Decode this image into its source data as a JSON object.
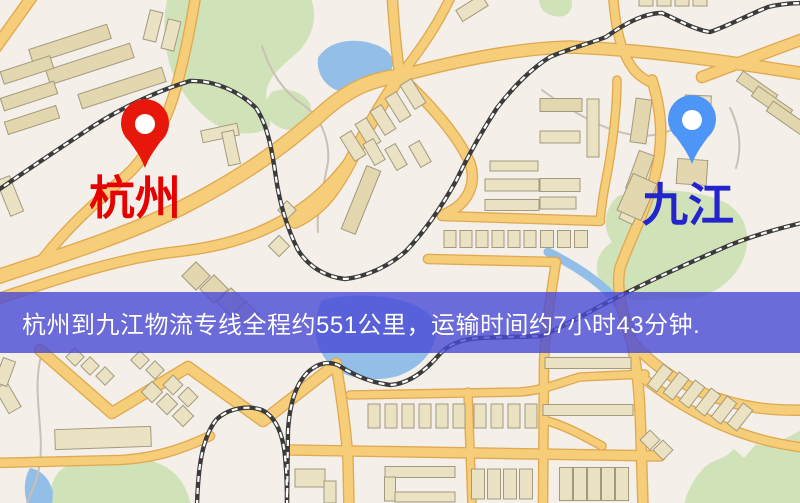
{
  "banner": {
    "text": "杭州到九江物流专线全程约551公里，运输时间约7小时43分钟.",
    "background_color": "rgba(74,74,214,0.8)",
    "text_color": "#ffffff",
    "top": 292,
    "height": 61
  },
  "map": {
    "background": "#f4efe8",
    "palette": {
      "green": "#cfe2b8",
      "water": "#93bee8",
      "road_fill": "#f6cd78",
      "road_casing": "#dfa851",
      "rail_dark": "#3b3b3b",
      "rail_light": "#ffffff",
      "building_fill": "#ebe2c4",
      "building_alt": "#e3d7af",
      "building_stroke": "#a39a7d",
      "trail": "#c9c1b3"
    },
    "labels": [
      {
        "id": "hangzhou",
        "text": "杭州",
        "color": "#e60000",
        "x": 135,
        "y": 214,
        "font_size": 46
      },
      {
        "id": "jiujiang",
        "text": "九江",
        "color": "#2424cd",
        "x": 688,
        "y": 221,
        "font_size": 46
      }
    ],
    "pins": [
      {
        "id": "hangzhou",
        "color": "#e8170b",
        "tip_x": 145,
        "tip_y": 168
      },
      {
        "id": "jiujiang",
        "color": "#4d95f6",
        "tip_x": 692,
        "tip_y": 164
      }
    ],
    "features": {
      "greens": [
        "M 168 -4 L 310 -4 C 318 14 314 34 300 50 C 285 64 272 72 267 88 C 264 104 272 114 270 126 C 258 136 238 136 218 126 C 198 114 180 94 170 66 C 163 40 163 16 168 -4 Z",
        "M 272 92 C 286 86 304 92 310 104 C 314 116 306 128 292 130 C 278 130 268 122 266 110 C 266 100 268 96 272 92 Z",
        "M 538 -4 L 570 -4 C 574 4 572 12 564 16 C 554 18 544 14 540 6 Z",
        "M 618 196 C 658 186 702 190 728 204 C 748 218 752 240 742 262 C 732 282 716 292 698 298 L 640 300 C 620 300 604 290 598 276 C 594 262 600 250 612 242 C 602 228 604 208 618 196 Z",
        "M 52 506 C 48 486 54 470 72 464 C 94 456 124 455 148 460 C 172 466 186 480 191 506 Z",
        "M 806 428 C 784 438 770 450 756 444 L 744 458 L 734 449 C 722 462 712 458 702 470 C 692 481 686 494 684 506 L 806 506 Z"
      ],
      "waters": [
        {
          "d": "M 318 58 C 326 44 346 38 366 42 C 386 46 396 56 392 68 C 386 82 366 92 344 92 C 328 90 316 76 318 58 Z",
          "mode": "fill"
        },
        {
          "d": "M 322 300 C 346 294 376 294 400 300 C 424 306 438 318 436 334 C 434 352 420 368 398 376 C 376 382 350 380 334 368 C 320 356 314 340 316 324 C 317 314 318 306 322 300 Z",
          "mode": "fill"
        },
        {
          "d": "M 30 468 C 42 470 50 480 53 492 L 52 506 L 28 506 C 23 492 24 478 30 468 Z",
          "mode": "fill"
        },
        {
          "d": "M 548 252 C 572 264 594 278 610 294 C 622 308 628 320 632 334",
          "mode": "stroke",
          "w": 9
        }
      ],
      "roads": [
        {
          "d": "M 34 -6 L -6 50",
          "w": 10
        },
        {
          "d": "M -6 278 C 60 256 130 234 185 206 C 243 176 283 148 322 113 C 352 86 375 79 400 76",
          "w": 13
        },
        {
          "d": "M -6 300 C 60 278 120 258 175 252 C 220 247 248 238 272 226 C 310 207 332 185 352 158",
          "w": 9
        },
        {
          "d": "M 400 76 C 382 103 366 130 352 158 C 334 193 320 210 295 222",
          "w": 11
        },
        {
          "d": "M 196 -6 C 190 30 184 60 176 88 C 168 116 154 146 132 170 C 112 190 78 214 42 260",
          "w": 9
        },
        {
          "d": "M 400 76 C 396 50 394 25 392 -6",
          "w": 9
        },
        {
          "d": "M 400 76 C 420 50 438 25 452 -6",
          "w": 8
        },
        {
          "d": "M 400 76 C 465 58 525 48 570 47 C 650 50 730 62 806 74",
          "w": 11
        },
        {
          "d": "M 702 77 C 740 63 772 50 806 38",
          "w": 10
        },
        {
          "d": "M 613 -6 C 615 25 620 52 634 70 C 640 77 646 80 652 83",
          "w": 8
        },
        {
          "d": "M 617 80 C 617 110 612 150 606 180 C 602 200 601 212 600 221",
          "w": 7
        },
        {
          "d": "M 652 80 C 662 112 664 142 655 176 C 646 210 628 244 620 268 C 615 292 625 318 632 344 C 638 372 640 400 641 440 L 643 506",
          "w": 9
        },
        {
          "d": "M 400 76 C 432 106 458 136 470 163 C 477 184 468 204 445 214",
          "w": 9
        },
        {
          "d": "M 442 216 L 600 221",
          "w": 8
        },
        {
          "d": "M 428 259 L 556 262 C 550 300 545 330 544 362 L 543 506",
          "w": 8
        },
        {
          "d": "M 350 395 L 520 392 C 545 390 562 382 580 377 L 645 374",
          "w": 7
        },
        {
          "d": "M 290 450 L 660 456",
          "w": 9
        },
        {
          "d": "M 40 350 L 112 413 L 188 367 L 263 421 L 336 364",
          "w": 10
        },
        {
          "d": "M 336 364 C 342 400 346 430 348 460 L 349 506",
          "w": 9
        },
        {
          "d": "M -6 463 L 120 460 C 155 458 180 450 210 436",
          "w": 8
        },
        {
          "d": "M 634 344 C 650 362 676 382 706 394 C 742 408 772 411 806 410",
          "w": 9
        },
        {
          "d": "M 641 376 C 660 392 688 410 718 424 C 750 438 775 444 806 448",
          "w": 8
        },
        {
          "d": "M 543 420 C 562 424 582 435 602 446",
          "w": 7
        },
        {
          "d": "M 468 392 L 472 506",
          "w": 7
        }
      ],
      "railways": [
        "M -6 193 C 30 168 60 148 95 125 C 125 106 160 90 190 81 C 215 80 240 92 256 108 C 268 126 272 150 276 178 C 280 205 288 230 298 250 C 308 266 325 277 345 279 C 365 277 388 267 406 251 C 425 231 442 206 456 181 C 468 156 482 131 497 108 C 513 87 532 68 550 57 C 568 49 588 44 606 37 C 624 24 644 13 662 13 C 678 20 695 30 710 32 C 726 27 748 15 768 7 C 780 4 792 3 806 3",
        "M 287 506 L 288 430 C 290 402 296 384 308 372 C 318 363 328 361 338 365 C 352 374 368 382 390 385 C 408 384 424 372 438 356 C 448 344 462 339 480 338 C 500 337 522 337 542 336 C 568 325 600 305 630 291 C 660 276 700 258 730 245 C 755 235 780 228 806 222",
        "M 197 506 C 198 468 202 438 216 420 C 228 408 248 405 262 410 C 274 416 281 430 284 448 C 286 462 287 480 287 506"
      ],
      "trails": [
        "M 262 46 C 270 72 284 92 302 104 C 320 116 330 138 328 162 C 324 186 316 210 318 232",
        "M 41 356 C 32 392 44 428 40 462 C 37 484 30 494 26 506",
        "M 542 90 C 575 114 612 136 646 136 C 674 133 692 120 714 112",
        "M 730 108 C 740 128 742 148 736 168"
      ],
      "buildings": [
        [
          70,
          44,
          82,
          15,
          -18,
          1
        ],
        [
          90,
          64,
          88,
          15,
          -18,
          1
        ],
        [
          122,
          88,
          88,
          15,
          -18,
          1
        ],
        [
          27,
          70,
          52,
          13,
          -18,
          1
        ],
        [
          29,
          96,
          56,
          13,
          -18,
          1
        ],
        [
          32,
          120,
          54,
          13,
          -18,
          1
        ],
        [
          153,
          26,
          13,
          30,
          14,
          0
        ],
        [
          171,
          35,
          13,
          30,
          14,
          0
        ],
        [
          220,
          133,
          37,
          12,
          -12,
          0
        ],
        [
          231,
          148,
          12,
          34,
          -12,
          0
        ],
        [
          472,
          8,
          30,
          13,
          -32,
          0
        ],
        [
          353,
          146,
          13,
          28,
          -32,
          0
        ],
        [
          368,
          133,
          13,
          28,
          -32,
          0
        ],
        [
          383,
          120,
          13,
          28,
          -32,
          0
        ],
        [
          398,
          107,
          13,
          28,
          -32,
          0
        ],
        [
          413,
          94,
          13,
          28,
          -32,
          0
        ],
        [
          374,
          152,
          12,
          24,
          -30,
          0
        ],
        [
          396,
          157,
          12,
          24,
          -30,
          0
        ],
        [
          420,
          154,
          12,
          24,
          -30,
          0
        ],
        [
          361,
          200,
          15,
          68,
          22,
          1
        ],
        [
          279,
          246,
          15,
          15,
          45,
          0
        ],
        [
          287,
          210,
          13,
          13,
          45,
          0
        ],
        [
          10,
          196,
          14,
          38,
          -22,
          0
        ],
        [
          646,
          1,
          14,
          10,
          0,
          0
        ],
        [
          664,
          1,
          14,
          10,
          0,
          0
        ],
        [
          682,
          1,
          14,
          10,
          0,
          0
        ],
        [
          700,
          1,
          14,
          10,
          0,
          0
        ],
        [
          757,
          88,
          42,
          12,
          35,
          1
        ],
        [
          772,
          103,
          42,
          12,
          35,
          1
        ],
        [
          787,
          118,
          42,
          12,
          35,
          1
        ],
        [
          641,
          121,
          16,
          44,
          8,
          1
        ],
        [
          640,
          172,
          16,
          40,
          20,
          1
        ],
        [
          633,
          206,
          15,
          34,
          26,
          0
        ],
        [
          692,
          172,
          30,
          25,
          4,
          1
        ],
        [
          698,
          103,
          26,
          15,
          2,
          0
        ],
        [
          561,
          105,
          42,
          13,
          0,
          1
        ],
        [
          560,
          137,
          40,
          12,
          0,
          0
        ],
        [
          593,
          128,
          12,
          58,
          0,
          0
        ],
        [
          560,
          185,
          40,
          13,
          0,
          0
        ],
        [
          558,
          203,
          36,
          12,
          0,
          0
        ],
        [
          450,
          239,
          12,
          17,
          0,
          0
        ],
        [
          466,
          239,
          12,
          17,
          0,
          0
        ],
        [
          482,
          239,
          12,
          17,
          0,
          0
        ],
        [
          498,
          239,
          12,
          17,
          0,
          0
        ],
        [
          514,
          239,
          12,
          17,
          0,
          0
        ],
        [
          530,
          239,
          12,
          17,
          0,
          0
        ],
        [
          547,
          239,
          13,
          17,
          0,
          0
        ],
        [
          564,
          239,
          13,
          17,
          0,
          0
        ],
        [
          581,
          239,
          13,
          17,
          0,
          0
        ],
        [
          512,
          185,
          54,
          12,
          0,
          0
        ],
        [
          512,
          205,
          54,
          11,
          0,
          0
        ],
        [
          514,
          166,
          48,
          10,
          0,
          0
        ],
        [
          637,
          197,
          26,
          40,
          24,
          1
        ],
        [
          103,
          438,
          96,
          20,
          -2,
          0
        ],
        [
          75,
          357,
          13,
          13,
          45,
          0
        ],
        [
          90,
          366,
          13,
          13,
          45,
          0
        ],
        [
          105,
          376,
          13,
          13,
          45,
          0
        ],
        [
          140,
          360,
          13,
          13,
          45,
          0
        ],
        [
          155,
          370,
          13,
          13,
          45,
          0
        ],
        [
          152,
          392,
          15,
          15,
          45,
          0
        ],
        [
          167,
          404,
          15,
          15,
          45,
          0
        ],
        [
          183,
          416,
          15,
          15,
          45,
          0
        ],
        [
          173,
          385,
          14,
          14,
          45,
          0
        ],
        [
          188,
          397,
          14,
          14,
          45,
          0
        ],
        [
          8,
          398,
          14,
          28,
          -30,
          0
        ],
        [
          5,
          372,
          13,
          26,
          20,
          0
        ],
        [
          196,
          276,
          20,
          20,
          45,
          1
        ],
        [
          214,
          289,
          20,
          20,
          45,
          1
        ],
        [
          231,
          302,
          20,
          20,
          45,
          1
        ],
        [
          246,
          314,
          18,
          18,
          45,
          1
        ],
        [
          374,
          416,
          12,
          24,
          0,
          0
        ],
        [
          391,
          416,
          12,
          24,
          0,
          0
        ],
        [
          408,
          416,
          12,
          24,
          0,
          0
        ],
        [
          425,
          416,
          12,
          24,
          0,
          0
        ],
        [
          442,
          416,
          12,
          24,
          0,
          0
        ],
        [
          459,
          416,
          12,
          24,
          0,
          0
        ],
        [
          480,
          416,
          12,
          24,
          0,
          0
        ],
        [
          497,
          416,
          12,
          24,
          0,
          0
        ],
        [
          514,
          416,
          12,
          24,
          0,
          0
        ],
        [
          531,
          416,
          12,
          24,
          0,
          0
        ],
        [
          310,
          478,
          30,
          18,
          0,
          0
        ],
        [
          330,
          492,
          12,
          22,
          0,
          0
        ],
        [
          420,
          472,
          70,
          11,
          0,
          0
        ],
        [
          390,
          489,
          11,
          24,
          0,
          0
        ],
        [
          425,
          497,
          60,
          10,
          0,
          0
        ],
        [
          478,
          484,
          13,
          30,
          0,
          0
        ],
        [
          494,
          484,
          13,
          30,
          0,
          0
        ],
        [
          510,
          484,
          13,
          30,
          0,
          0
        ],
        [
          526,
          484,
          13,
          30,
          0,
          0
        ],
        [
          566,
          484,
          13,
          33,
          0,
          0
        ],
        [
          580,
          484,
          13,
          33,
          0,
          0
        ],
        [
          594,
          484,
          13,
          33,
          0,
          0
        ],
        [
          608,
          484,
          13,
          33,
          0,
          0
        ],
        [
          622,
          484,
          13,
          33,
          0,
          0
        ],
        [
          588,
          363,
          86,
          11,
          0,
          0
        ],
        [
          588,
          410,
          90,
          11,
          0,
          0
        ],
        [
          660,
          378,
          12,
          26,
          38,
          0
        ],
        [
          676,
          386,
          12,
          26,
          38,
          0
        ],
        [
          692,
          394,
          12,
          26,
          38,
          0
        ],
        [
          708,
          402,
          12,
          26,
          38,
          0
        ],
        [
          724,
          410,
          12,
          26,
          38,
          0
        ],
        [
          740,
          417,
          12,
          26,
          38,
          0
        ],
        [
          650,
          440,
          14,
          14,
          45,
          0
        ],
        [
          663,
          450,
          14,
          14,
          45,
          0
        ]
      ]
    }
  }
}
